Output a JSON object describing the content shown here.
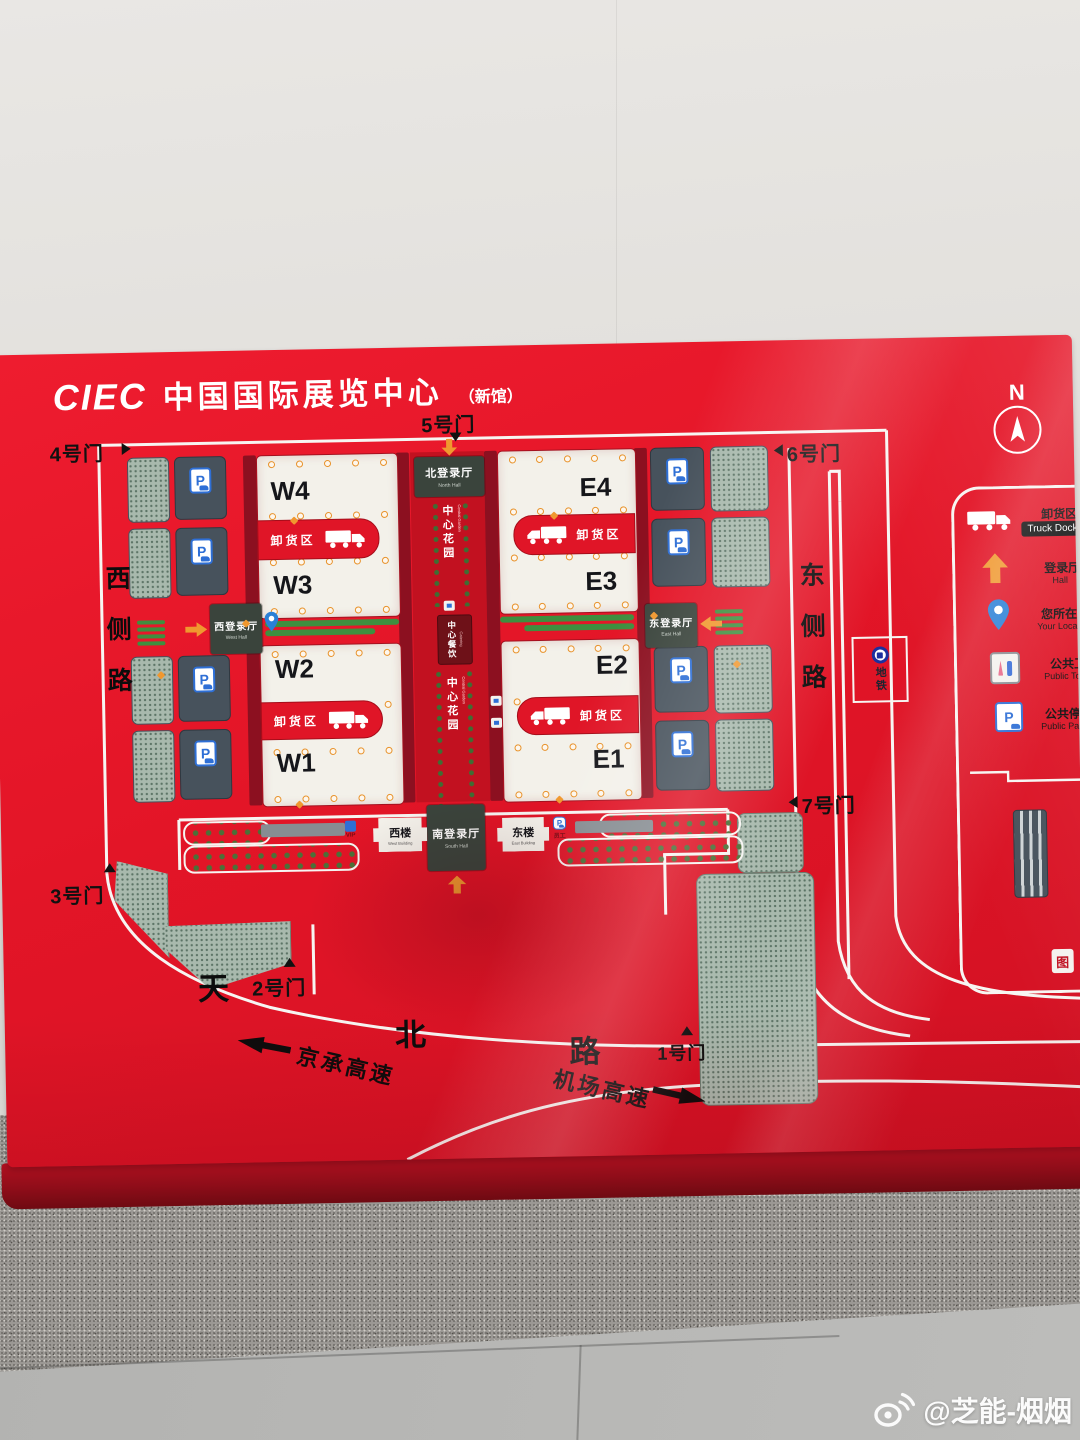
{
  "board": {
    "logo": {
      "abbr": "CIEC",
      "name": "中国国际展览中心",
      "suffix": "（新馆）"
    },
    "compass_label": "N",
    "gates": {
      "gate1": "1号门",
      "gate2": "2号门",
      "gate3": "3号门",
      "gate4": "4号门",
      "gate5": "5号门",
      "gate6": "6号门",
      "gate7": "7号门"
    },
    "roads": {
      "west_side": "西侧路",
      "east_side": "东侧路",
      "tianbei": [
        "天",
        "北",
        "路"
      ],
      "jingcheng": "京承高速",
      "airport": "机场高速"
    },
    "halls": [
      {
        "label": "W4"
      },
      {
        "label": "W3"
      },
      {
        "label": "W2"
      },
      {
        "label": "W1"
      },
      {
        "label": "E4"
      },
      {
        "label": "E3"
      },
      {
        "label": "E2"
      },
      {
        "label": "E1"
      }
    ],
    "unload_zone_label": "卸货区",
    "entrances": {
      "north": {
        "zh": "北登录厅",
        "en": "North Hall"
      },
      "west": {
        "zh": "西登录厅",
        "en": "West Hall"
      },
      "east": {
        "zh": "东登录厅",
        "en": "East Hall"
      },
      "south": {
        "zh": "南登录厅",
        "en": "South Hall"
      }
    },
    "center": {
      "garden_zh": "中心花园",
      "garden_en": "Central Garden",
      "catering_zh": "中心餐饮",
      "catering_en": "Catering"
    },
    "buildings": {
      "west": {
        "zh": "西楼",
        "en": "West Building"
      },
      "east": {
        "zh": "东楼",
        "en": "East Building"
      }
    },
    "metro_label": "地铁",
    "vip_label": "VIP",
    "staff_label": "员工",
    "legend": [
      {
        "zh": "卸货区",
        "en": "Truck Dock",
        "icon": "truck-icon"
      },
      {
        "zh": "登录厅",
        "en": "Hall",
        "icon": "up-arrow-icon"
      },
      {
        "zh": "您所在位置",
        "en": "Your Location",
        "icon": "location-pin-icon"
      },
      {
        "zh": "公共卫生间",
        "en": "Public Toilet",
        "icon": "toilet-icon"
      },
      {
        "zh": "公共停车场",
        "en": "Public Parking",
        "icon": "parking-icon"
      }
    ],
    "map_seal": "图"
  },
  "watermark": {
    "handle": "@芝能-烟烟"
  },
  "colors": {
    "board_red": "#e31527",
    "maroon": "#8c1020",
    "accent_orange": "#f0982f",
    "hall_white": "#f3f1ea",
    "legend_blue": "#2e6fd6"
  }
}
